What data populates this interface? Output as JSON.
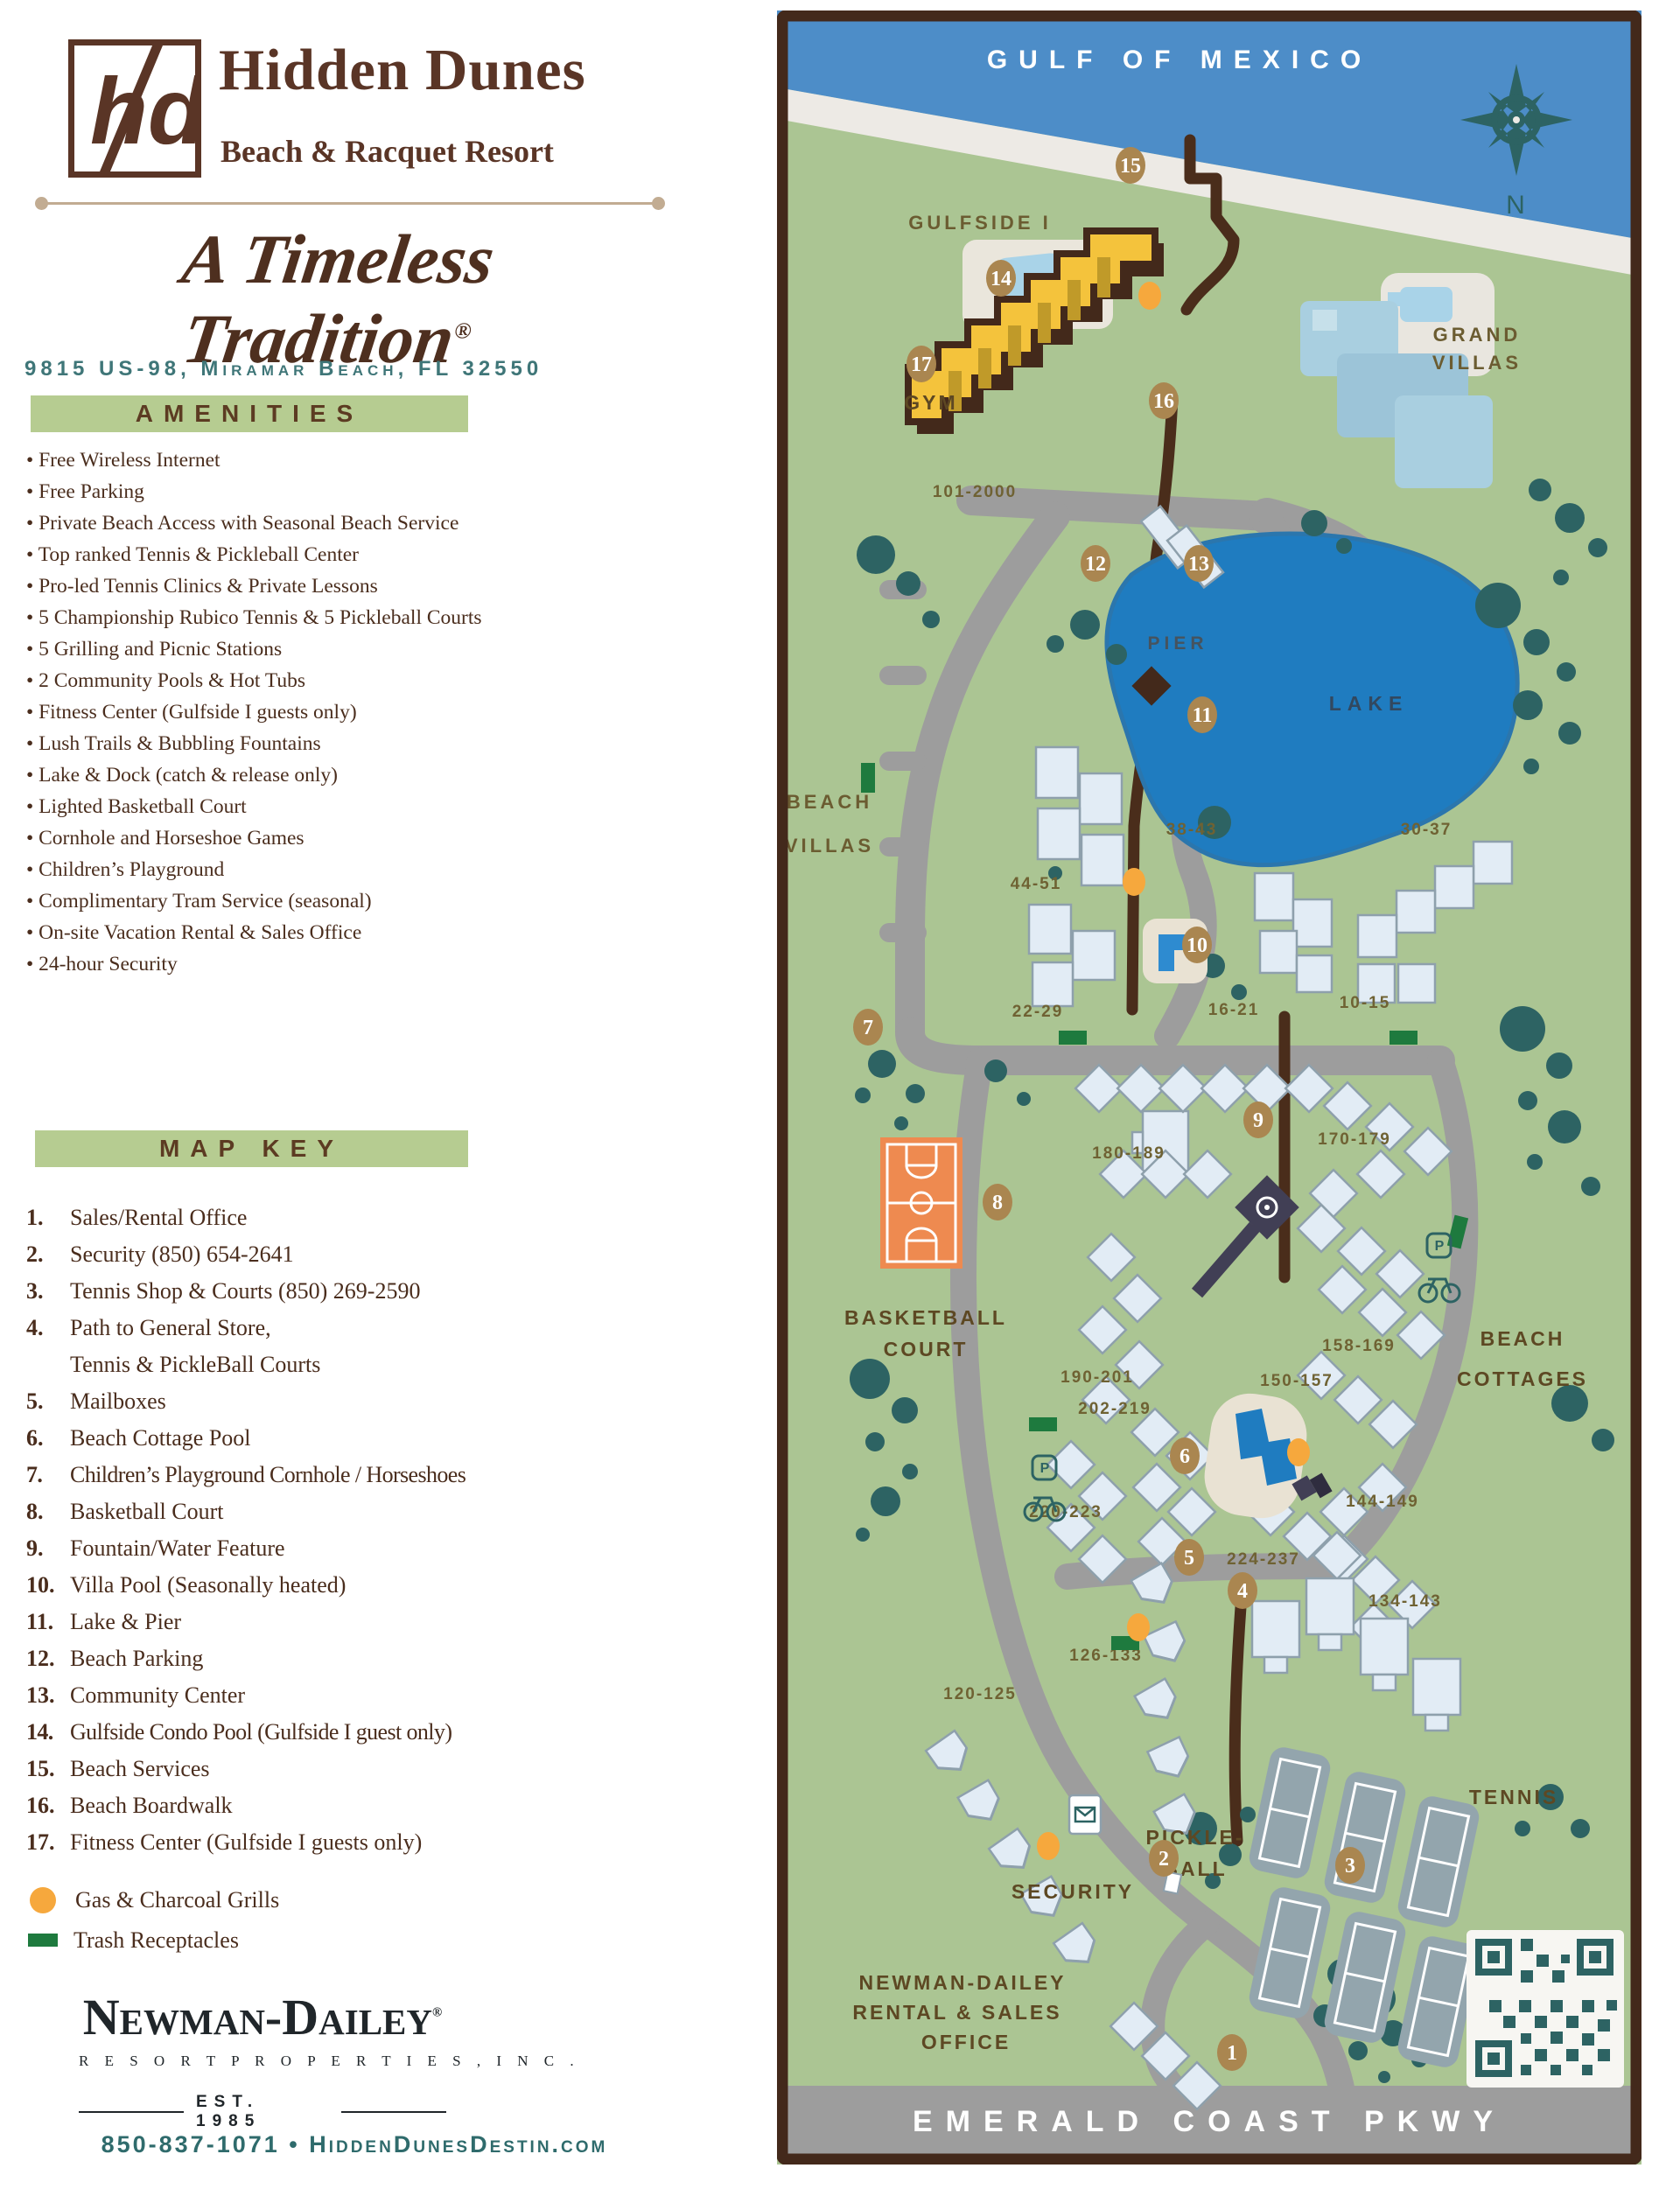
{
  "brand": {
    "monogram": "hd",
    "title": "Hidden Dunes",
    "subtitle": "Beach & Racquet Resort",
    "tagline": "A Timeless Tradition",
    "registered": "®",
    "address": "9815 US-98, Miramar Beach, FL 32550"
  },
  "amenities": {
    "title": "AMENITIES",
    "items": [
      "Free Wireless Internet",
      "Free Parking",
      "Private Beach Access with Seasonal Beach Service",
      "Top ranked Tennis & Pickleball Center",
      "Pro-led Tennis Clinics & Private Lessons",
      "5 Championship Rubico Tennis & 5 Pickleball Courts",
      "5 Grilling and Picnic Stations",
      "2 Community Pools & Hot Tubs",
      "Fitness Center (Gulfside I guests only)",
      "Lush Trails & Bubbling Fountains",
      "Lake & Dock (catch & release only)",
      "Lighted Basketball Court",
      "Cornhole and Horseshoe Games",
      "Children’s Playground",
      "Complimentary Tram Service (seasonal)",
      "On-site Vacation Rental & Sales Office",
      "24-hour Security"
    ]
  },
  "map_key": {
    "title": "MAP KEY",
    "entries": [
      {
        "num": "1.",
        "label": "Sales/Rental Office"
      },
      {
        "num": "2.",
        "label": "Security (850) 654-2641"
      },
      {
        "num": "3.",
        "label": "Tennis Shop & Courts (850) 269-2590"
      },
      {
        "num": "4.",
        "label": "Path to General Store,",
        "label2": "Tennis & PickleBall Courts"
      },
      {
        "num": "5.",
        "label": "Mailboxes"
      },
      {
        "num": "6.",
        "label": "Beach Cottage Pool"
      },
      {
        "num": "7.",
        "label": "Children’s Playground Cornhole / Horseshoes"
      },
      {
        "num": "8.",
        "label": "Basketball Court"
      },
      {
        "num": "9.",
        "label": "Fountain/Water Feature"
      },
      {
        "num": "10.",
        "label": "Villa Pool (Seasonally heated)"
      },
      {
        "num": "11.",
        "label": "Lake & Pier"
      },
      {
        "num": "12.",
        "label": "Beach Parking"
      },
      {
        "num": "13.",
        "label": "Community Center"
      },
      {
        "num": "14.",
        "label": "Gulfside Condo Pool (Gulfside I guest only)"
      },
      {
        "num": "15.",
        "label": "Beach Services"
      },
      {
        "num": "16.",
        "label": "Beach Boardwalk"
      },
      {
        "num": "17.",
        "label": "Fitness Center (Gulfside I guests only)"
      }
    ],
    "legend": [
      {
        "icon": "grill-icon",
        "label": "Gas & Charcoal Grills"
      },
      {
        "icon": "trash-icon",
        "label": "Trash Receptacles"
      }
    ]
  },
  "footer": {
    "company": "Newman-Dailey",
    "registered": "®",
    "subtitle": "R E S O R T   P R O P E R T I E S ,   I N C .",
    "established": "EST. 1985",
    "contact": "850-837-1071  •  HiddenDunesDestin.com"
  },
  "map": {
    "labels": {
      "gulf": "GULF OF MEXICO",
      "north": "N",
      "gulfside": "GULFSIDE I",
      "grand1": "GRAND",
      "grand2": "VILLAS",
      "gym": "GYM",
      "pier": "PIER",
      "lake": "LAKE",
      "beach_villas1": "BEACH",
      "beach_villas2": "VILLAS",
      "basketball1": "BASKETBALL",
      "basketball2": "COURT",
      "beach_cottages1": "BEACH",
      "beach_cottages2": "COTTAGES",
      "pickleball1": "PICKLE-",
      "pickleball2": "BALL",
      "tennis": "TENNIS",
      "security": "SECURITY",
      "office1": "NEWMAN-DAILEY",
      "office2": "RENTAL & SALES",
      "office3": "OFFICE",
      "parkway": "EMERALD COAST PKWY"
    },
    "units": {
      "u101": "101-2000",
      "u44": "44-51",
      "u38": "38-43",
      "u30": "30-37",
      "u22": "22-29",
      "u16": "16-21",
      "u10": "10-15",
      "u180": "180-189",
      "u170": "170-179",
      "u190": "190-201",
      "u158": "158-169",
      "u150": "150-157",
      "u202": "202-219",
      "u144": "144-149",
      "u220": "220-223",
      "u224": "224-237",
      "u134": "134-143",
      "u126": "126-133",
      "u120": "120-125"
    },
    "markers": {
      "m1": "1",
      "m2": "2",
      "m3": "3",
      "m4": "4",
      "m5": "5",
      "m6": "6",
      "m7": "7",
      "m8": "8",
      "m9": "9",
      "m10": "10",
      "m11": "11",
      "m12": "12",
      "m13": "13",
      "m14": "14",
      "m15": "15",
      "m16": "16",
      "m17": "17"
    },
    "icons": {
      "parking": "P"
    },
    "colors": {
      "land": "#abc593",
      "water": "#4d8dc8",
      "beach": "#edeae5",
      "lake": "#1f7cc0",
      "border": "#43291b",
      "road": "#9d9d9d",
      "tree": "#2d6363",
      "marker": "#aa8650",
      "grill": "#f6a83d",
      "trash": "#1e7a3e",
      "court_orange": "#ee8a50",
      "accent_teal": "#2f6b6c",
      "accent_green": "#b6cc91",
      "text_brown": "#4a2d1d",
      "building_yellow": "#f4c33c"
    }
  }
}
